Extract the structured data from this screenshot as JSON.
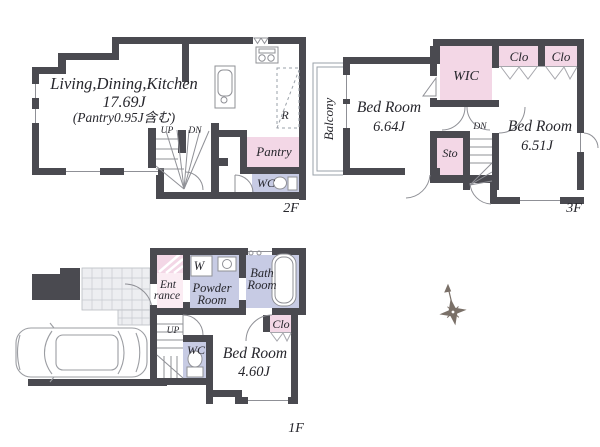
{
  "floor2": {
    "floor_label": "2F",
    "ldk_name": "Living,Dining,Kitchen",
    "ldk_size": "17.69J",
    "ldk_note": "(Pantry0.95J含む)",
    "pantry_label": "Pantry",
    "wc_label": "WC",
    "fridge_label": "R",
    "up_label": "UP",
    "dn_label": "DN"
  },
  "floor3": {
    "floor_label": "3F",
    "balcony_label": "Balcony",
    "bedroom1_name": "Bed Room",
    "bedroom1_size": "6.64J",
    "wic_label": "WIC",
    "clo1_label": "Clo",
    "clo2_label": "Clo",
    "sto_label": "Sto",
    "dn_label": "DN",
    "bedroom2_name": "Bed Room",
    "bedroom2_size": "6.51J"
  },
  "floor1": {
    "floor_label": "1F",
    "entrance_line1": "Ent",
    "entrance_line2": "rance",
    "washer_label": "W",
    "powder_line1": "Powder",
    "powder_line2": "Room",
    "bath_line1": "Bath",
    "bath_line2": "Room",
    "clo_label": "Clo",
    "wc_label": "WC",
    "up_label": "UP",
    "bedroom_name": "Bed Room",
    "bedroom_size": "4.60J"
  },
  "colors": {
    "wall": "#4a4a50",
    "closet_pink": "#f3d7e6",
    "wet_lavender": "#c7cbe4"
  }
}
